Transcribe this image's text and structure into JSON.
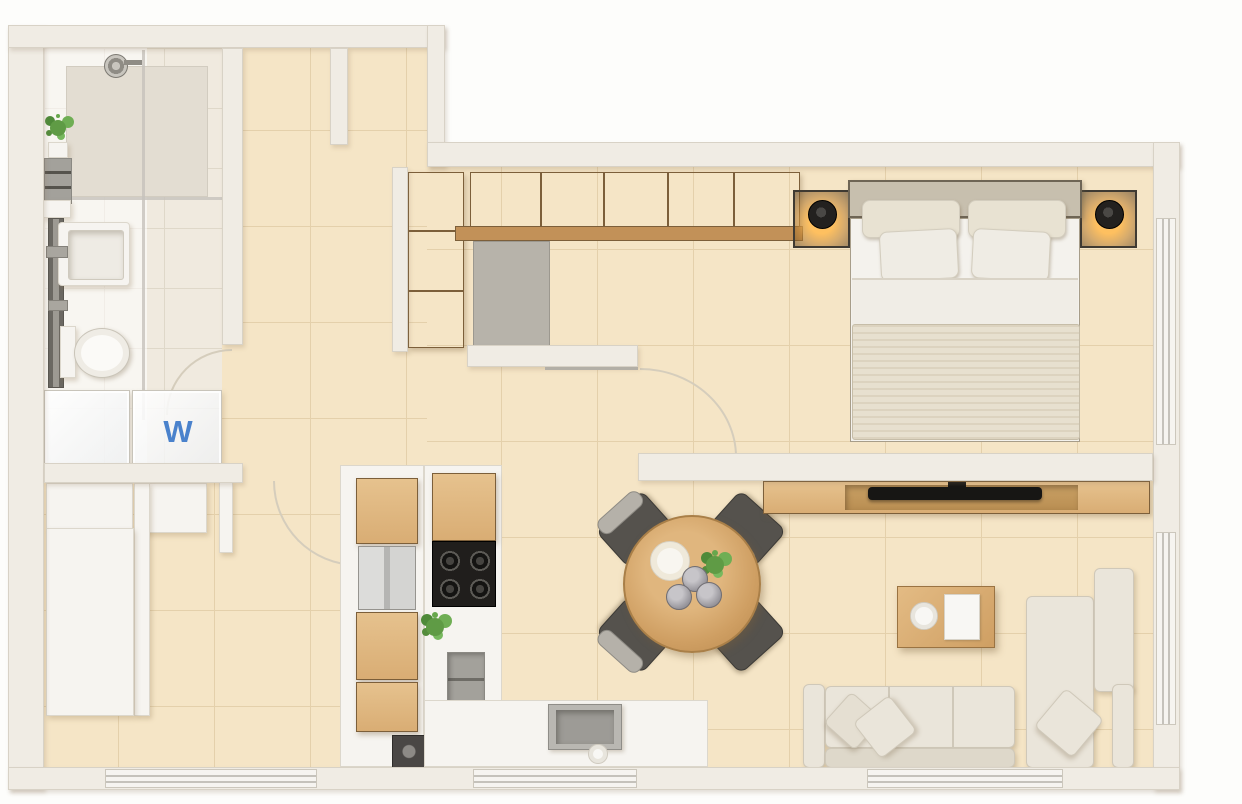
{
  "labels": {
    "washer": "W"
  },
  "rooms": [
    "bathroom",
    "laundry-closet",
    "entry-hall",
    "corridor",
    "walk-in-closet",
    "bedroom",
    "kitchen",
    "dining-area",
    "living-room"
  ],
  "colors": {
    "exterior": "#fdfdfb",
    "wall": "#f0ece4",
    "wall_edge": "#d8d2c6",
    "floor": "#f5e5c4",
    "floor_grout": "#e4cfa8",
    "floor_bath": "#f0eadf",
    "floor_bath_grout": "#dfd8c9",
    "floor_shower": "#e3ddd2",
    "wood": "#d9ad74",
    "wood_light": "#e6c28e",
    "wood_edge": "#7c5f3a",
    "white_furniture": "#f6f4f0",
    "fabric": "#eae5da",
    "fabric_dark": "#e7e0cf",
    "steel": "#d2d2d0",
    "gray_item": "#a3a19b",
    "black_item": "#201e1c",
    "glass": "#c5c2bb",
    "green": "#5f9b45",
    "washer_blue": "#4a82cc"
  }
}
